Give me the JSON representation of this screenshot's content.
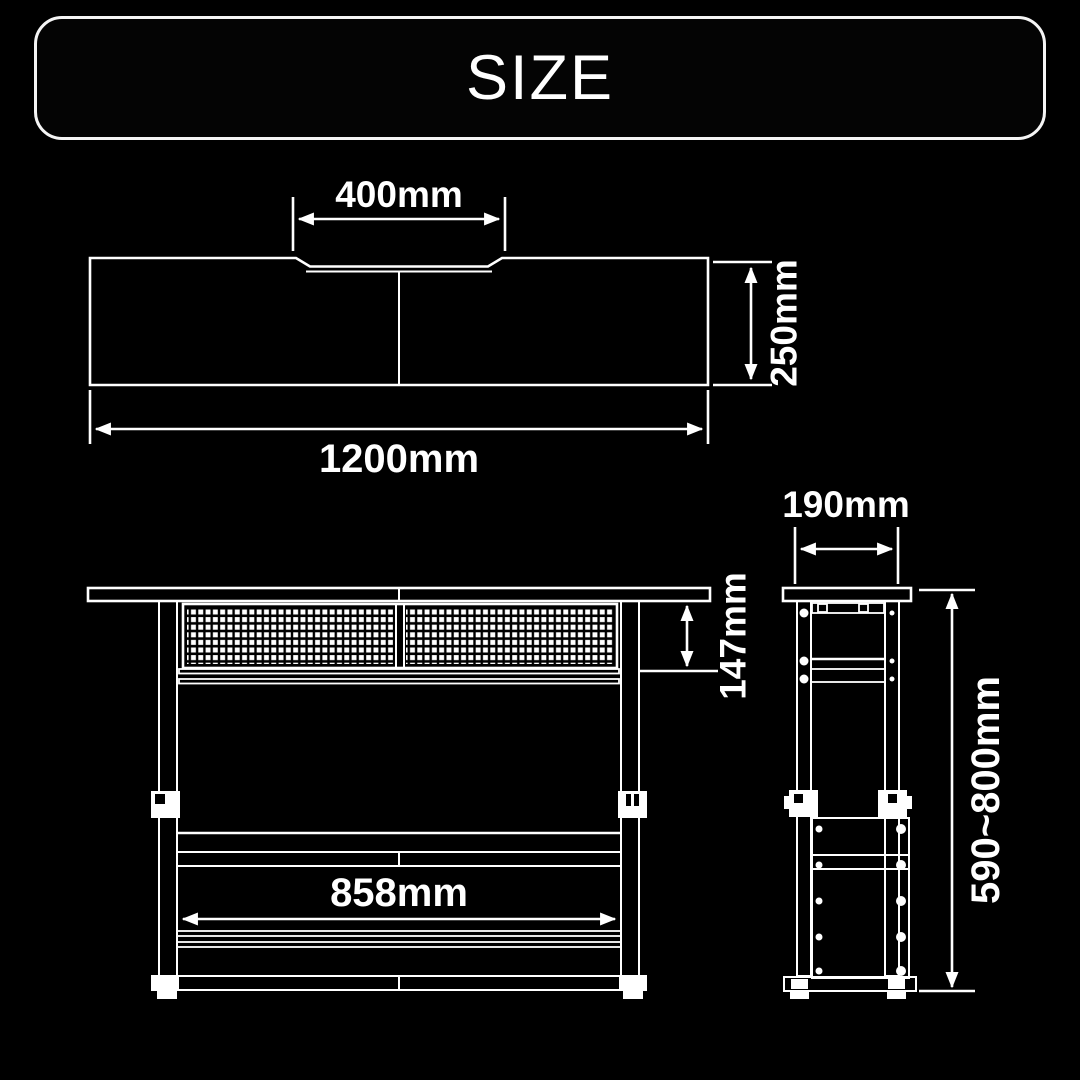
{
  "header": {
    "title": "SIZE"
  },
  "colors": {
    "background": "#000000",
    "line": "#ffffff",
    "text": "#ffffff"
  },
  "top_view": {
    "notch_width": "400mm",
    "depth": "250mm",
    "total_width": "1200mm"
  },
  "front_view": {
    "mesh_height": "147mm",
    "inner_width": "858mm"
  },
  "side_view": {
    "frame_depth": "190mm",
    "height_range": "590~800mm"
  }
}
